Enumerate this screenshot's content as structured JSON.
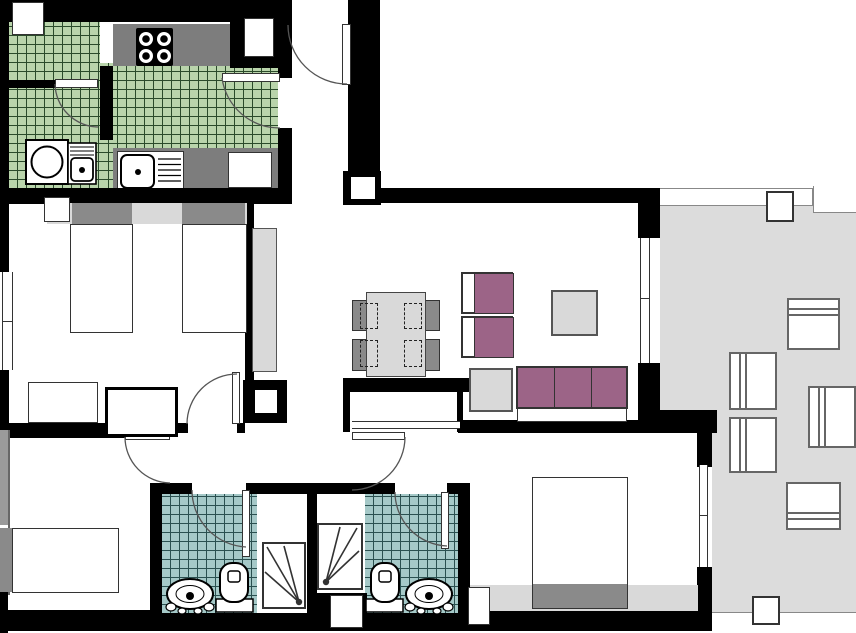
{
  "canvas": {
    "width": 856,
    "height": 633
  },
  "colors": {
    "wall": "#000000",
    "line": "#333333",
    "kitchen-tile": "#b9d4ab",
    "kitchen-tile-line": "#2a4a2a",
    "bath-tile": "#a5c9c8",
    "bath-tile-line": "#2a5050",
    "terrace": "#dcdcdc",
    "furniture-light": "#d9d9d9",
    "furniture-dark": "#8a8a8a",
    "counter": "#7d7d7d",
    "upholstery": "#9c6487",
    "pillow": "#808080"
  },
  "inventory": {
    "rooms": [
      "kitchen",
      "laundry-nook",
      "entry-hall",
      "twin-bedroom",
      "single-bedroom",
      "master-bedroom",
      "bathroom-1",
      "bathroom-2",
      "living-dining-room",
      "hallway",
      "terrace"
    ],
    "fixtures": [
      "stove-4-burner",
      "kitchen-sink",
      "laundry-sink",
      "washing-machine",
      "tall-cabinet",
      "twin-beds",
      "single-bed",
      "double-bed",
      "wardrobes",
      "dining-table",
      "dining-chairs-4",
      "armchairs-2",
      "sofa-3-seat",
      "coffee-table",
      "side-table",
      "toilets-2",
      "washbasins-2",
      "showers-2",
      "terrace-chairs-5",
      "doors-with-swing-arcs",
      "windows"
    ]
  }
}
